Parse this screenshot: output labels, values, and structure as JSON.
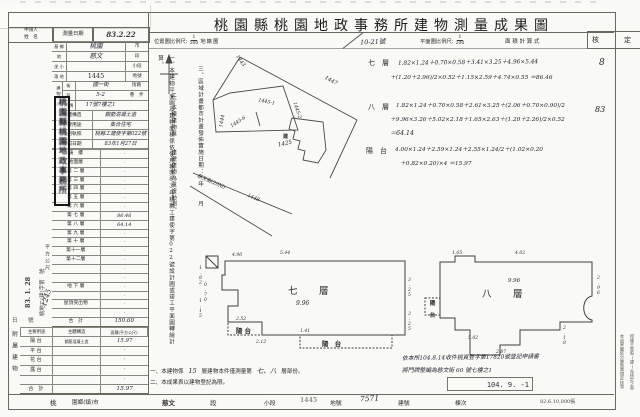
{
  "title": "桃園縣桃園地政事務所建物測量成果圖",
  "print_info": "82.6.10,000張",
  "scale_row": {
    "location_label": "位置圖比例尺:",
    "location_num": "1",
    "location_den": "500",
    "cadastral_label": "地籍圖",
    "sheet_no": "10-21號",
    "plan_label": "平面圖比例尺:",
    "plan_num": "1",
    "plan_den": "200",
    "calc_label": "面 積 計 算 式",
    "approve_label": "核　定",
    "approve_mark1": "8",
    "approve_mark2": "83"
  },
  "form": {
    "applicant_l1": "申請人",
    "applicant_l2": "姓　名",
    "survey_label": "測量日期",
    "survey_value": "83.2.22",
    "site_rows": [
      {
        "pre": "基 鄉",
        "value": "桃園",
        "suf": "市",
        "hand": true
      },
      {
        "pre": "地",
        "value": "慈文",
        "suf": "段",
        "hand": true
      },
      {
        "pre": "坐 小",
        "value": "",
        "suf": "小段",
        "hand": false
      },
      {
        "pre": "落 地",
        "value": "1445",
        "suf": "地號",
        "hand": false
      }
    ],
    "addr_group": "建物門牌",
    "addr_rows": [
      {
        "pre": "街",
        "value": "國一街",
        "suf": "街路",
        "hand": true
      },
      {
        "pre": "段",
        "value": "5-2",
        "suf": "巷　弄",
        "hand": true
      },
      {
        "pre": "門 牌",
        "value": "17號7樓之1",
        "suf": "",
        "hand": true
      }
    ],
    "field_rows": [
      {
        "label": "主體構造",
        "value": "鋼筋混凝土造",
        "hand": true
      },
      {
        "label": "主要用途",
        "value": "集合住宅",
        "hand": true
      },
      {
        "label": "使用執照",
        "value": "桃縣工建使字第022號",
        "hand": true
      },
      {
        "label": "發照日期",
        "value": "83年1月27日",
        "hand": true
      }
    ]
  },
  "floors": {
    "unit_label": "平方公尺",
    "rows": [
      {
        "label": "騎　樓",
        "value": "·"
      },
      {
        "label": "地面層",
        "value": "·"
      },
      {
        "label": "第 二 層",
        "value": "·"
      },
      {
        "label": "第 三 層",
        "value": "·"
      },
      {
        "label": "第 四 層",
        "value": "·"
      },
      {
        "label": "第 五 層",
        "value": "·"
      },
      {
        "label": "第 六 層",
        "value": "·"
      },
      {
        "label": "第 七 層",
        "value": "86.46"
      },
      {
        "label": "第 八 層",
        "value": "64.14"
      },
      {
        "label": "第 九 層",
        "value": "·"
      },
      {
        "label": "第 十 層",
        "value": "·"
      },
      {
        "label": "第十一層",
        "value": "·"
      },
      {
        "label": "第十二層",
        "value": "·"
      },
      {
        "label": "",
        "value": "·"
      },
      {
        "label": "",
        "value": "·"
      },
      {
        "label": "地 下 層",
        "value": "·"
      },
      {
        "label": "",
        "value": "·"
      },
      {
        "label": "屋頂突出物",
        "value": "·"
      },
      {
        "label": "",
        "value": "·"
      }
    ],
    "total_label": "合　計",
    "total": "150.60"
  },
  "annex": {
    "group_label": "附屬建物",
    "h_use": "主要用途",
    "h_struct": "主體構造",
    "h_area": "面積(平方公尺)",
    "rows": [
      {
        "use": "陽 台",
        "struct": "鋼筋混凝土造",
        "area": "15.97"
      },
      {
        "use": "平 台",
        "struct": "",
        "area": "·"
      },
      {
        "use": "花 台",
        "struct": "",
        "area": "·"
      },
      {
        "use": "露 台",
        "struct": "",
        "area": "·"
      },
      {
        "use": "",
        "struct": "",
        "area": "·"
      }
    ],
    "total_label": "合　計",
    "total": "15.97"
  },
  "receipt": {
    "line1": "桃地二(建)字第　號",
    "date": "83. 1. 28",
    "number": "1245",
    "tail": "日　　號"
  },
  "seal": "桃園縣桃園地政事務所",
  "notes": {
    "n1": "一、本建物平面圖及建物面積係依使用執照83年桃縣工建使字第022號設計圖或竣工平面圖轉繪計算。",
    "n2": "二、本棟建物與　　建號建物為重複勘測。",
    "n3": "三、區域計畫都市計畫發佈實施日期：　年　　月"
  },
  "map": {
    "p1443": "1443",
    "p1447": "1447",
    "p1444": "1444",
    "p1445_1": "1445-1",
    "p1445_2": "1445-2",
    "p1445_6": "1445-6",
    "p1448": "1448",
    "bldg_mark": "建",
    "bldg_no": "1425",
    "road": "慈文街(20M)"
  },
  "calc": {
    "f7_label": "七　層",
    "f7_l1": "1.82×1.24＋0.70×0.58＋3.41×3.25＋4.96×5.44",
    "f7_l2": "＋(1.20＋2.96)/2×0.52＋1.15×2.59＋4.74×0.55 ＝86.46",
    "f8_label": "八　層",
    "f8_l1": "1.82×1.24＋0.70×0.58＋2.61×3.25＋(2.06＋0.70×0.90)/2",
    "f8_l2": "＋9.96×3.26＋5.02×2.18＋1.65×2.63＋(1.20＋2.26)/2×0.52",
    "f8_l3": "＝64.14",
    "bal_label": "陽　台",
    "bal_l1": "4.00×1.24＋2.59×1.24＋2.55×1.24/2＋(1.02×0.20",
    "bal_l2": "＋0.82×0.20)×4 ＝15.97"
  },
  "plan7": {
    "label": "七　層",
    "area": "9.96",
    "balcony_left": "陽 台",
    "balcony_bottom": "陽　台",
    "d_top1": "4.96",
    "d_top2": "5.44",
    "d_r1": "3.25",
    "d_r2": "3.25",
    "d_b1": "1.41",
    "d_b2": "2.12",
    "d_l1": "1.82",
    "d_l2": "0.70",
    "d_l3": "1.15",
    "d_l4": "2.52"
  },
  "plan8": {
    "label": "八　層",
    "area": "9.96",
    "balcony": "陽 台",
    "d1": "1.65",
    "d2": "4.02",
    "d3": "2.96",
    "d4": "2.18",
    "d5": "2.87",
    "d6": "5.02"
  },
  "footnotes": {
    "f1_pre": "一、本建物係",
    "f1_hand1": "15",
    "f1_mid": "層建物本件僅測量第",
    "f1_hand2": "七、八",
    "f1_post": "層部份。",
    "f2": "二、本成果表以建物登記為限。"
  },
  "bottom": {
    "county": "桃",
    "township": "園鄉(鎮)市",
    "section": "慈文",
    "section_label": "段",
    "subsection_label": "小段",
    "parcel": "1445",
    "parcel_label": "地號",
    "building_no": "7571",
    "building_label": "建號",
    "unit_label": "棟次"
  },
  "annotation": {
    "l1": "依本所104.8.14收件桃資登字第17820號登記申請書",
    "l2": "將門牌整編為慈文街 60 號七樓之1",
    "stamp_date": "104. 9. -1"
  },
  "margin": {
    "colA": "授權主管股(課)長核定之章",
    "colB": "本成果圖依分層負責規定核發"
  }
}
